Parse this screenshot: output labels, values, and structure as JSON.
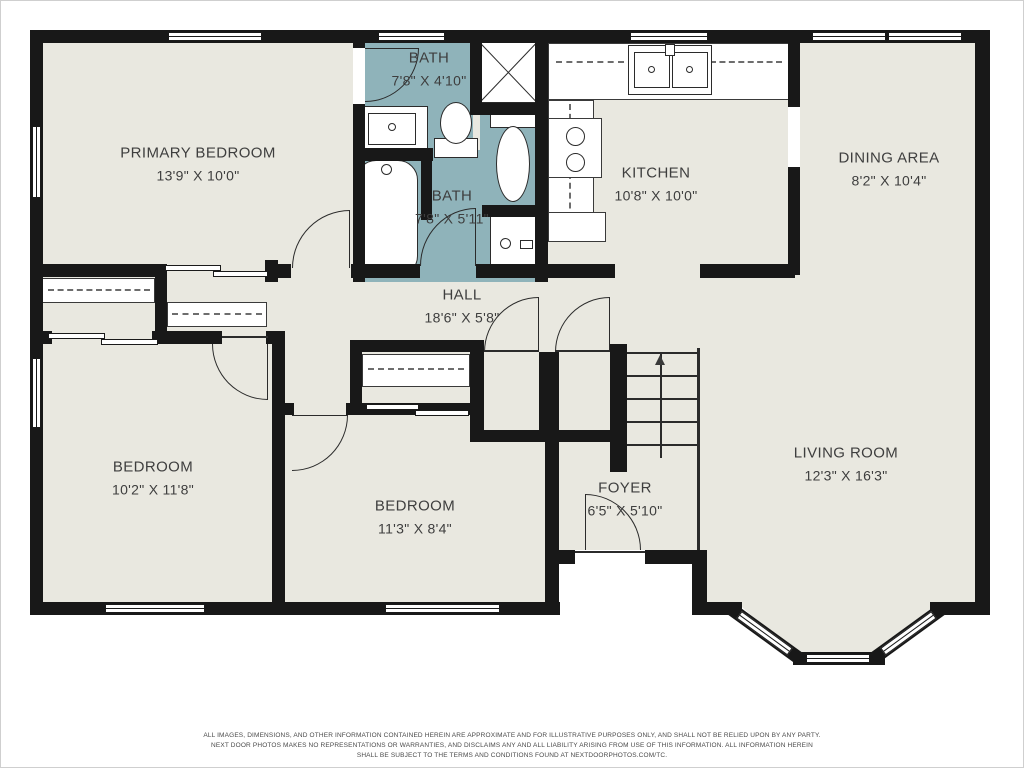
{
  "rooms": [
    {
      "name": "PRIMARY BEDROOM",
      "dims": "13'9\" X 10'0\""
    },
    {
      "name": "BATH",
      "dims": "7'8\" X 4'10\""
    },
    {
      "name": "BATH",
      "dims": "7'8\" X 5'11\""
    },
    {
      "name": "KITCHEN",
      "dims": "10'8\" X 10'0\""
    },
    {
      "name": "DINING AREA",
      "dims": "8'2\" X 10'4\""
    },
    {
      "name": "HALL",
      "dims": "18'6\" X 5'8\""
    },
    {
      "name": "BEDROOM",
      "dims": "10'2\" X 11'8\""
    },
    {
      "name": "BEDROOM",
      "dims": "11'3\" X 8'4\""
    },
    {
      "name": "FOYER",
      "dims": "6'5\" X 5'10\""
    },
    {
      "name": "LIVING ROOM",
      "dims": "12'3\" X 16'3\""
    }
  ],
  "fixtures": [
    "bathtub",
    "shower",
    "toilet",
    "sink-vanity",
    "kitchen-sink",
    "stove",
    "refrigerator",
    "vanity-cabinet",
    "staircase",
    "closet-rod",
    "bay-window"
  ],
  "stairs": {
    "direction_arrow": "up"
  },
  "colors": {
    "wall": "#181818",
    "room_fill": "#e9e8e0",
    "bath_fill": "#8fb3ba",
    "fixture_fill": "#ffffff",
    "label_text": "#3e3e3e"
  },
  "disclaimer": {
    "line1": "ALL IMAGES, DIMENSIONS, AND OTHER INFORMATION CONTAINED HEREIN ARE APPROXIMATE AND FOR ILLUSTRATIVE PURPOSES ONLY, AND SHALL NOT BE RELIED UPON BY ANY PARTY.",
    "line2": "NEXT DOOR PHOTOS MAKES NO REPRESENTATIONS OR WARRANTIES, AND DISCLAIMS ANY AND ALL LIABILITY ARISING FROM USE OF THIS INFORMATION. ALL INFORMATION HEREIN",
    "line3": "SHALL BE SUBJECT TO THE TERMS AND CONDITIONS FOUND AT NEXTDOORPHOTOS.COM/TC."
  }
}
